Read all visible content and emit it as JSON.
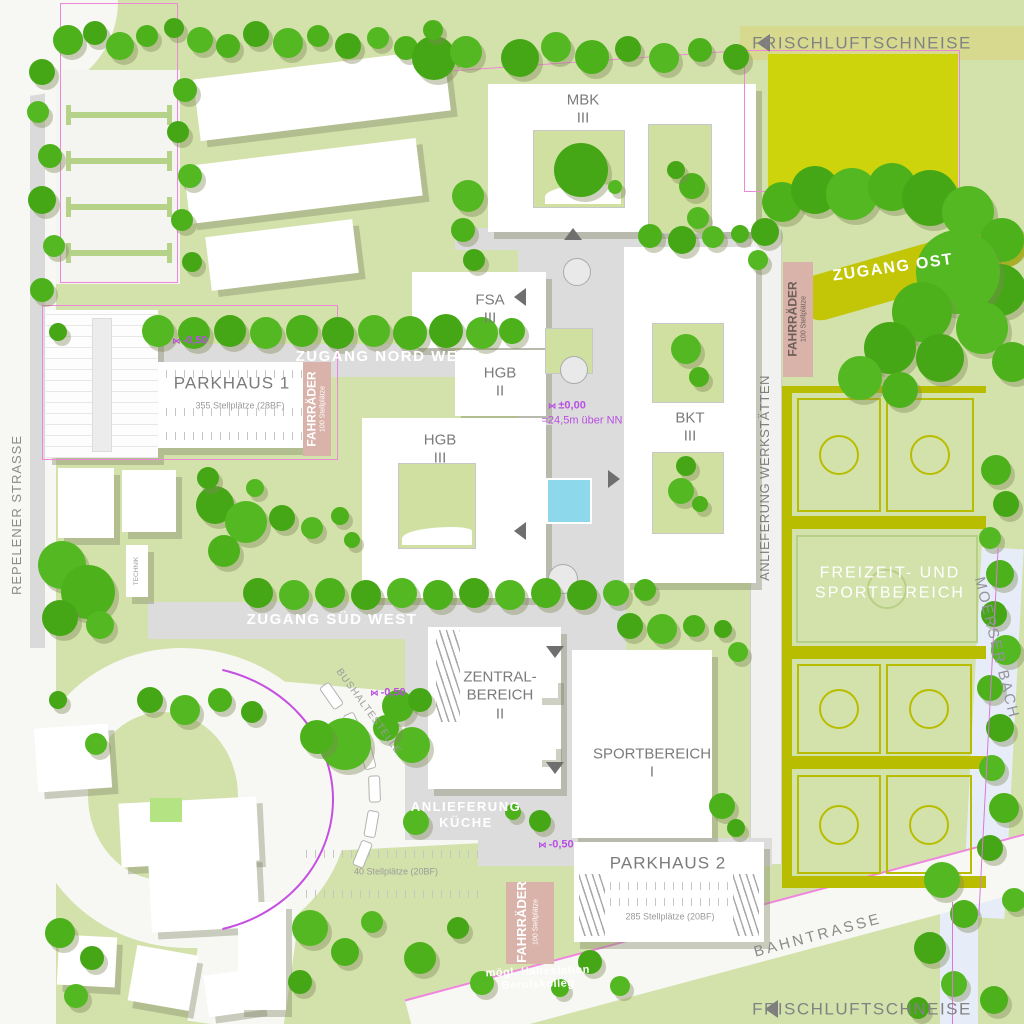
{
  "plan": {
    "corridors": {
      "top": "FRISCHLUFTSCHNEISE",
      "bottom": "FRISCHLUFTSCHNEISE"
    },
    "streets": {
      "repelener": "REPELENER STRASSE",
      "bahntrasse": "BAHNTRASSE",
      "bach": "MOERSER BACH"
    },
    "entrances": {
      "nw": "ZUGANG NORD WEST",
      "sw": "ZUGANG SÜD WEST",
      "ost": "ZUGANG OST"
    },
    "buildings": {
      "mbk_name": "MBK",
      "mbk_lv": "III",
      "fsa_name": "FSA",
      "fsa_lv": "III",
      "hgb2_name": "HGB",
      "hgb2_lv": "II",
      "hgb3_name": "HGB",
      "hgb3_lv": "III",
      "bkt_name": "BKT",
      "bkt_lv": "III",
      "zentral_l1": "ZENTRAL-",
      "zentral_l2": "BEREICH",
      "zentral_lv": "II",
      "sport_name": "SPORTBEREICH",
      "sport_lv": "I",
      "technik": "TECHNIK"
    },
    "parking": {
      "ph1_name": "PARKHAUS 1",
      "ph1_cap": "355 Stellplätze (28BF)",
      "ph2_name": "PARKHAUS 2",
      "ph2_cap": "285 Stellplätze (20BF)",
      "lot_cap": "40 Stellplätze (20BF)",
      "bike_name": "FAHRRÄDER",
      "bike_cap": "100 Stellplätze"
    },
    "service": {
      "werk": "ANLIEFERUNG WERKSTÄTTEN",
      "kueche_l1": "ANLIEFERUNG",
      "kueche_l2": "KÜCHE"
    },
    "areas": {
      "freizeit_l1": "FREIZEIT- UND",
      "freizeit_l2": "SPORTBEREICH"
    },
    "transit": {
      "bus": "BUSHALTESTELLE",
      "halt_l1": "mögl. Haltestation",
      "halt_l2": "Berufskolleg"
    },
    "levels": {
      "zero": "±0,00",
      "zero_sub": "=24,5m über NN",
      "minus": "-0,50"
    },
    "colors": {
      "tree_green": "#4cb11b",
      "olive": "#b9bd00",
      "field_yellow": "#cdd40b",
      "boundary_pink": "#ee86d9",
      "level_magenta": "#b84fe2",
      "bike_rose": "#d9b2aa",
      "pool_blue": "#8ed8ec",
      "background_green": "#d3e2ab"
    }
  }
}
